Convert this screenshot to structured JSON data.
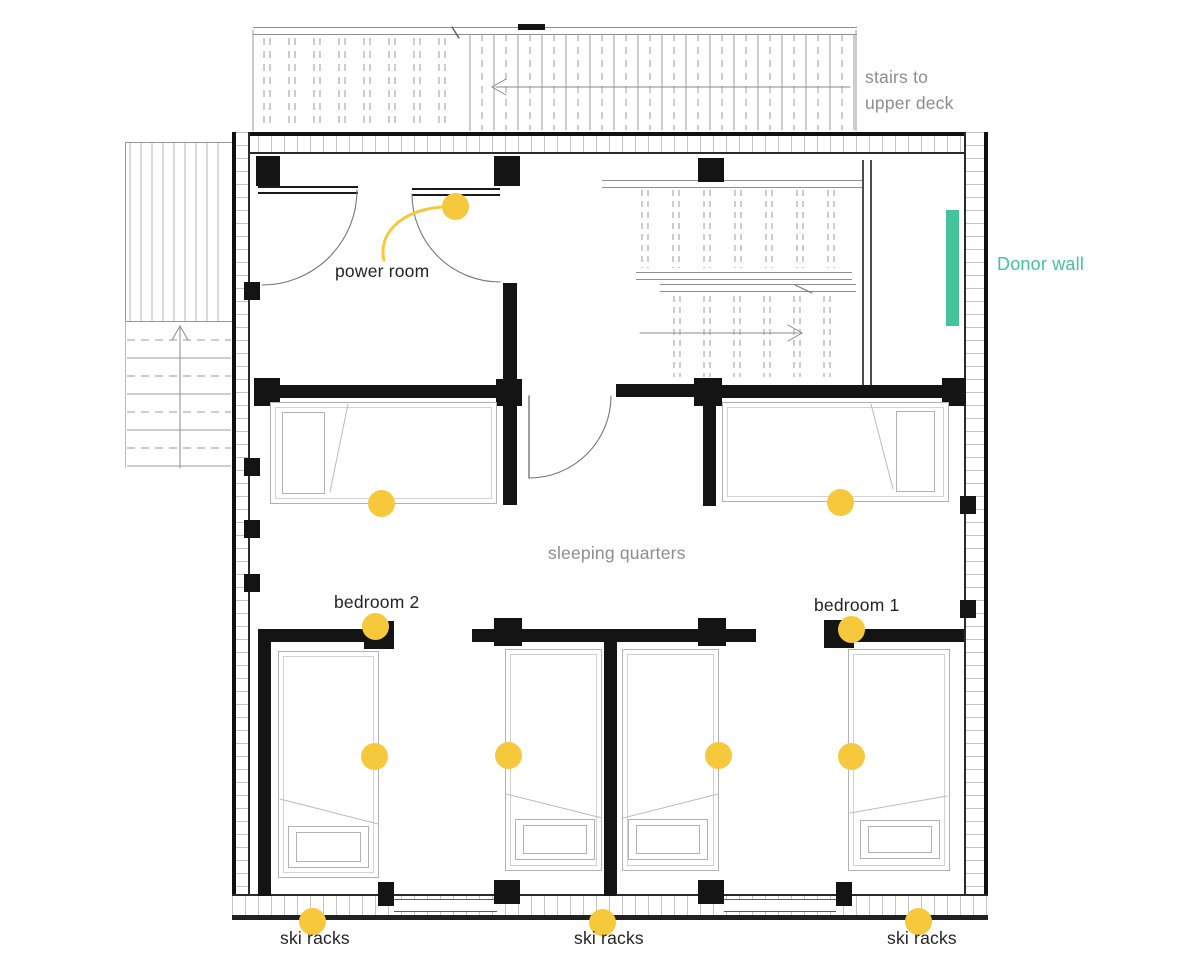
{
  "colors": {
    "accent_yellow": "#F6C83C",
    "accent_teal": "#45C49A",
    "wall_black": "#141414",
    "line_gray": "#9b9b9b",
    "label_dark": "#242424",
    "label_gray": "#8d8d8d"
  },
  "labels": {
    "stairs_upper_deck_line1": "stairs to",
    "stairs_upper_deck_line2": "upper deck",
    "power_room": "power room",
    "donor_wall": "Donor wall",
    "sleeping_quarters": "sleeping quarters",
    "bedroom_2": "bedroom 2",
    "bedroom_1": "bedroom 1",
    "ski_racks": "ski racks"
  },
  "annotations": {
    "light_marker_count": 12,
    "ski_rack_label_count": 3
  }
}
